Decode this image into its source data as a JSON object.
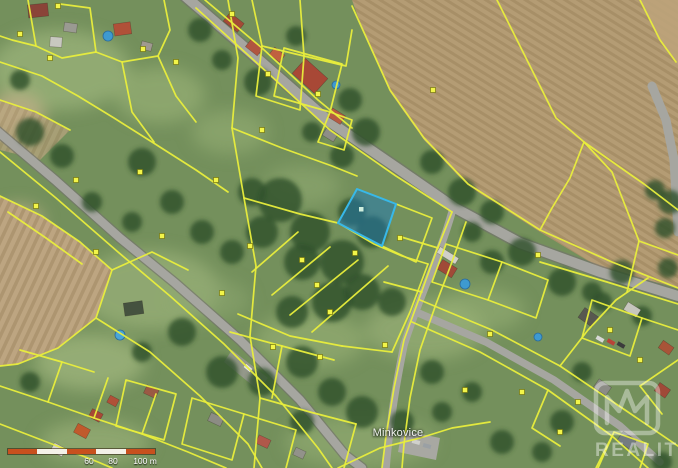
{
  "map": {
    "place_label": "Minkovice"
  },
  "watermark": {
    "text": "REALITY",
    "logo": "mm-reality-house-logo"
  },
  "scalebar": {
    "labels": [
      "60",
      "80",
      "100 m"
    ]
  },
  "colors": {
    "parcel_line": "#e9ee3c",
    "parcel_marker": "#f2f549",
    "highlight_fill": "#1e78b4",
    "highlight_stroke": "#38b8e8",
    "field_tan": "#b49c74",
    "road_gray": "#a6a6a0",
    "scalebar_orange": "#c8501e",
    "grass_green": "#74905c",
    "tree_green": "#31502c"
  }
}
